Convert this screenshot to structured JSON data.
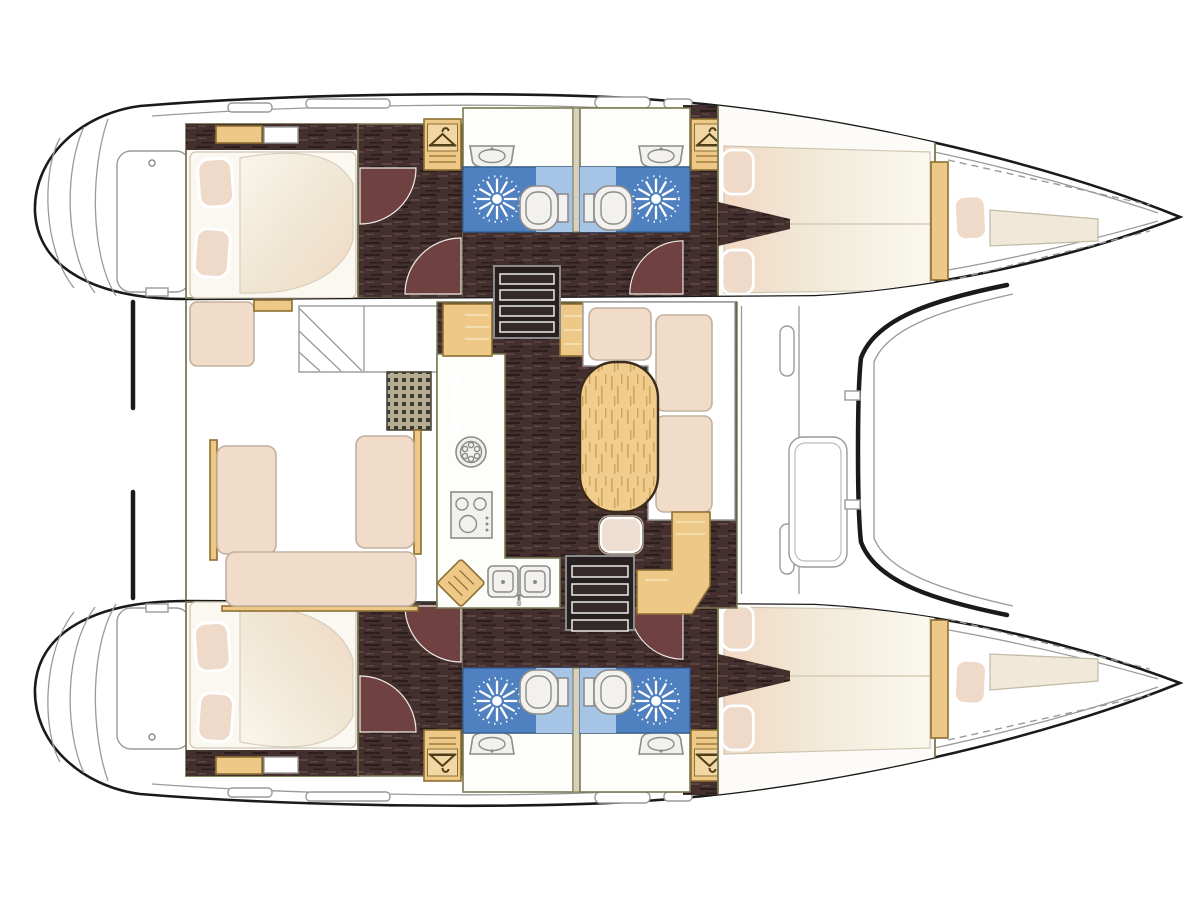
{
  "meta": {
    "title": "Catamaran interior layout — top-down floor plan, bow to the right",
    "diagram_type": "yacht-floor-plan",
    "hulls": 2
  },
  "colors": {
    "outline": "#1a1a1a",
    "thin_line": "#9a9a9a",
    "wall": "#7a7a52",
    "room_fill": "#fcfbf7",
    "wood": "#eec886",
    "wood_edge": "#8d6f33",
    "floor_dark": "#43302e",
    "floor_streak_a": "#2b1d1c",
    "floor_streak_b": "#5d4341",
    "door_swing": "#6f4140",
    "bath_blue": "#4f80c0",
    "bath_panel": "#a6c4e5",
    "white_fixture": "#f2f1ed",
    "fixture_line": "#8c8c8c",
    "cushion": "#f1dcc9",
    "cushion_line": "#c2b09f",
    "pillow": "#efd9c9",
    "table_wood": "#f1cd8d",
    "table_grain": "#cfa45e",
    "grate_bg": "#b5ac92",
    "grate_dot": "#39392f",
    "step_dark": "#262020",
    "bg": "#ffffff"
  },
  "rooms": [
    {
      "id": "port-aft-cabin",
      "label": "Port aft double cabin",
      "features": [
        "double berth",
        "2 pillows",
        "headboard shelf"
      ]
    },
    {
      "id": "port-aft-bathroom",
      "label": "Port aft bathroom",
      "features": [
        "shower",
        "toilet",
        "washbasin",
        "wardrobe"
      ]
    },
    {
      "id": "port-fwd-bathroom",
      "label": "Port forward bathroom",
      "features": [
        "shower",
        "toilet",
        "washbasin",
        "wardrobe"
      ]
    },
    {
      "id": "port-bow-cabin",
      "label": "Port bow double cabin",
      "features": [
        "double berth",
        "2 pillows"
      ]
    },
    {
      "id": "port-forepeak",
      "label": "Port forepeak",
      "features": [
        "single berth",
        "pillow"
      ]
    },
    {
      "id": "starboard-aft-cabin",
      "label": "Starboard aft double cabin",
      "features": [
        "double berth",
        "2 pillows",
        "headboard shelf"
      ]
    },
    {
      "id": "starboard-aft-bathroom",
      "label": "Starboard aft bathroom",
      "features": [
        "shower",
        "toilet",
        "washbasin",
        "wardrobe"
      ]
    },
    {
      "id": "starboard-fwd-bathroom",
      "label": "Starboard forward bathroom",
      "features": [
        "shower",
        "toilet",
        "washbasin",
        "wardrobe"
      ]
    },
    {
      "id": "starboard-bow-cabin",
      "label": "Starboard bow double cabin",
      "features": [
        "double berth",
        "2 pillows"
      ]
    },
    {
      "id": "starboard-forepeak",
      "label": "Starboard forepeak",
      "features": [
        "single berth",
        "pillow"
      ]
    },
    {
      "id": "saloon",
      "label": "Saloon and galley",
      "features": [
        "L-shaped galley",
        "3-burner stove",
        "double sink",
        "round sink",
        "cutting board",
        "oval dining table",
        "L-shaped sofa",
        "stool",
        "chart desk",
        "2 companionway stairs",
        "storage cabinets"
      ]
    },
    {
      "id": "cockpit",
      "label": "Aft cockpit",
      "features": [
        "U-shaped bench",
        "helm seat",
        "side steps",
        "deck grating"
      ]
    },
    {
      "id": "foredeck",
      "label": "Foredeck",
      "features": [
        "large deck hatch",
        "curved coachroof front"
      ]
    }
  ],
  "galley": {
    "stove_burners": 3,
    "sink_bowls": 2,
    "round_sink": 1
  },
  "counts": {
    "cabins": 4,
    "bathrooms": 4,
    "showers": 4,
    "toilets": 4,
    "washbasins": 4,
    "wardrobes": 4,
    "companionway_stairs": 2,
    "stern_swim_platforms": 2,
    "foredeck_hatch": 1
  }
}
